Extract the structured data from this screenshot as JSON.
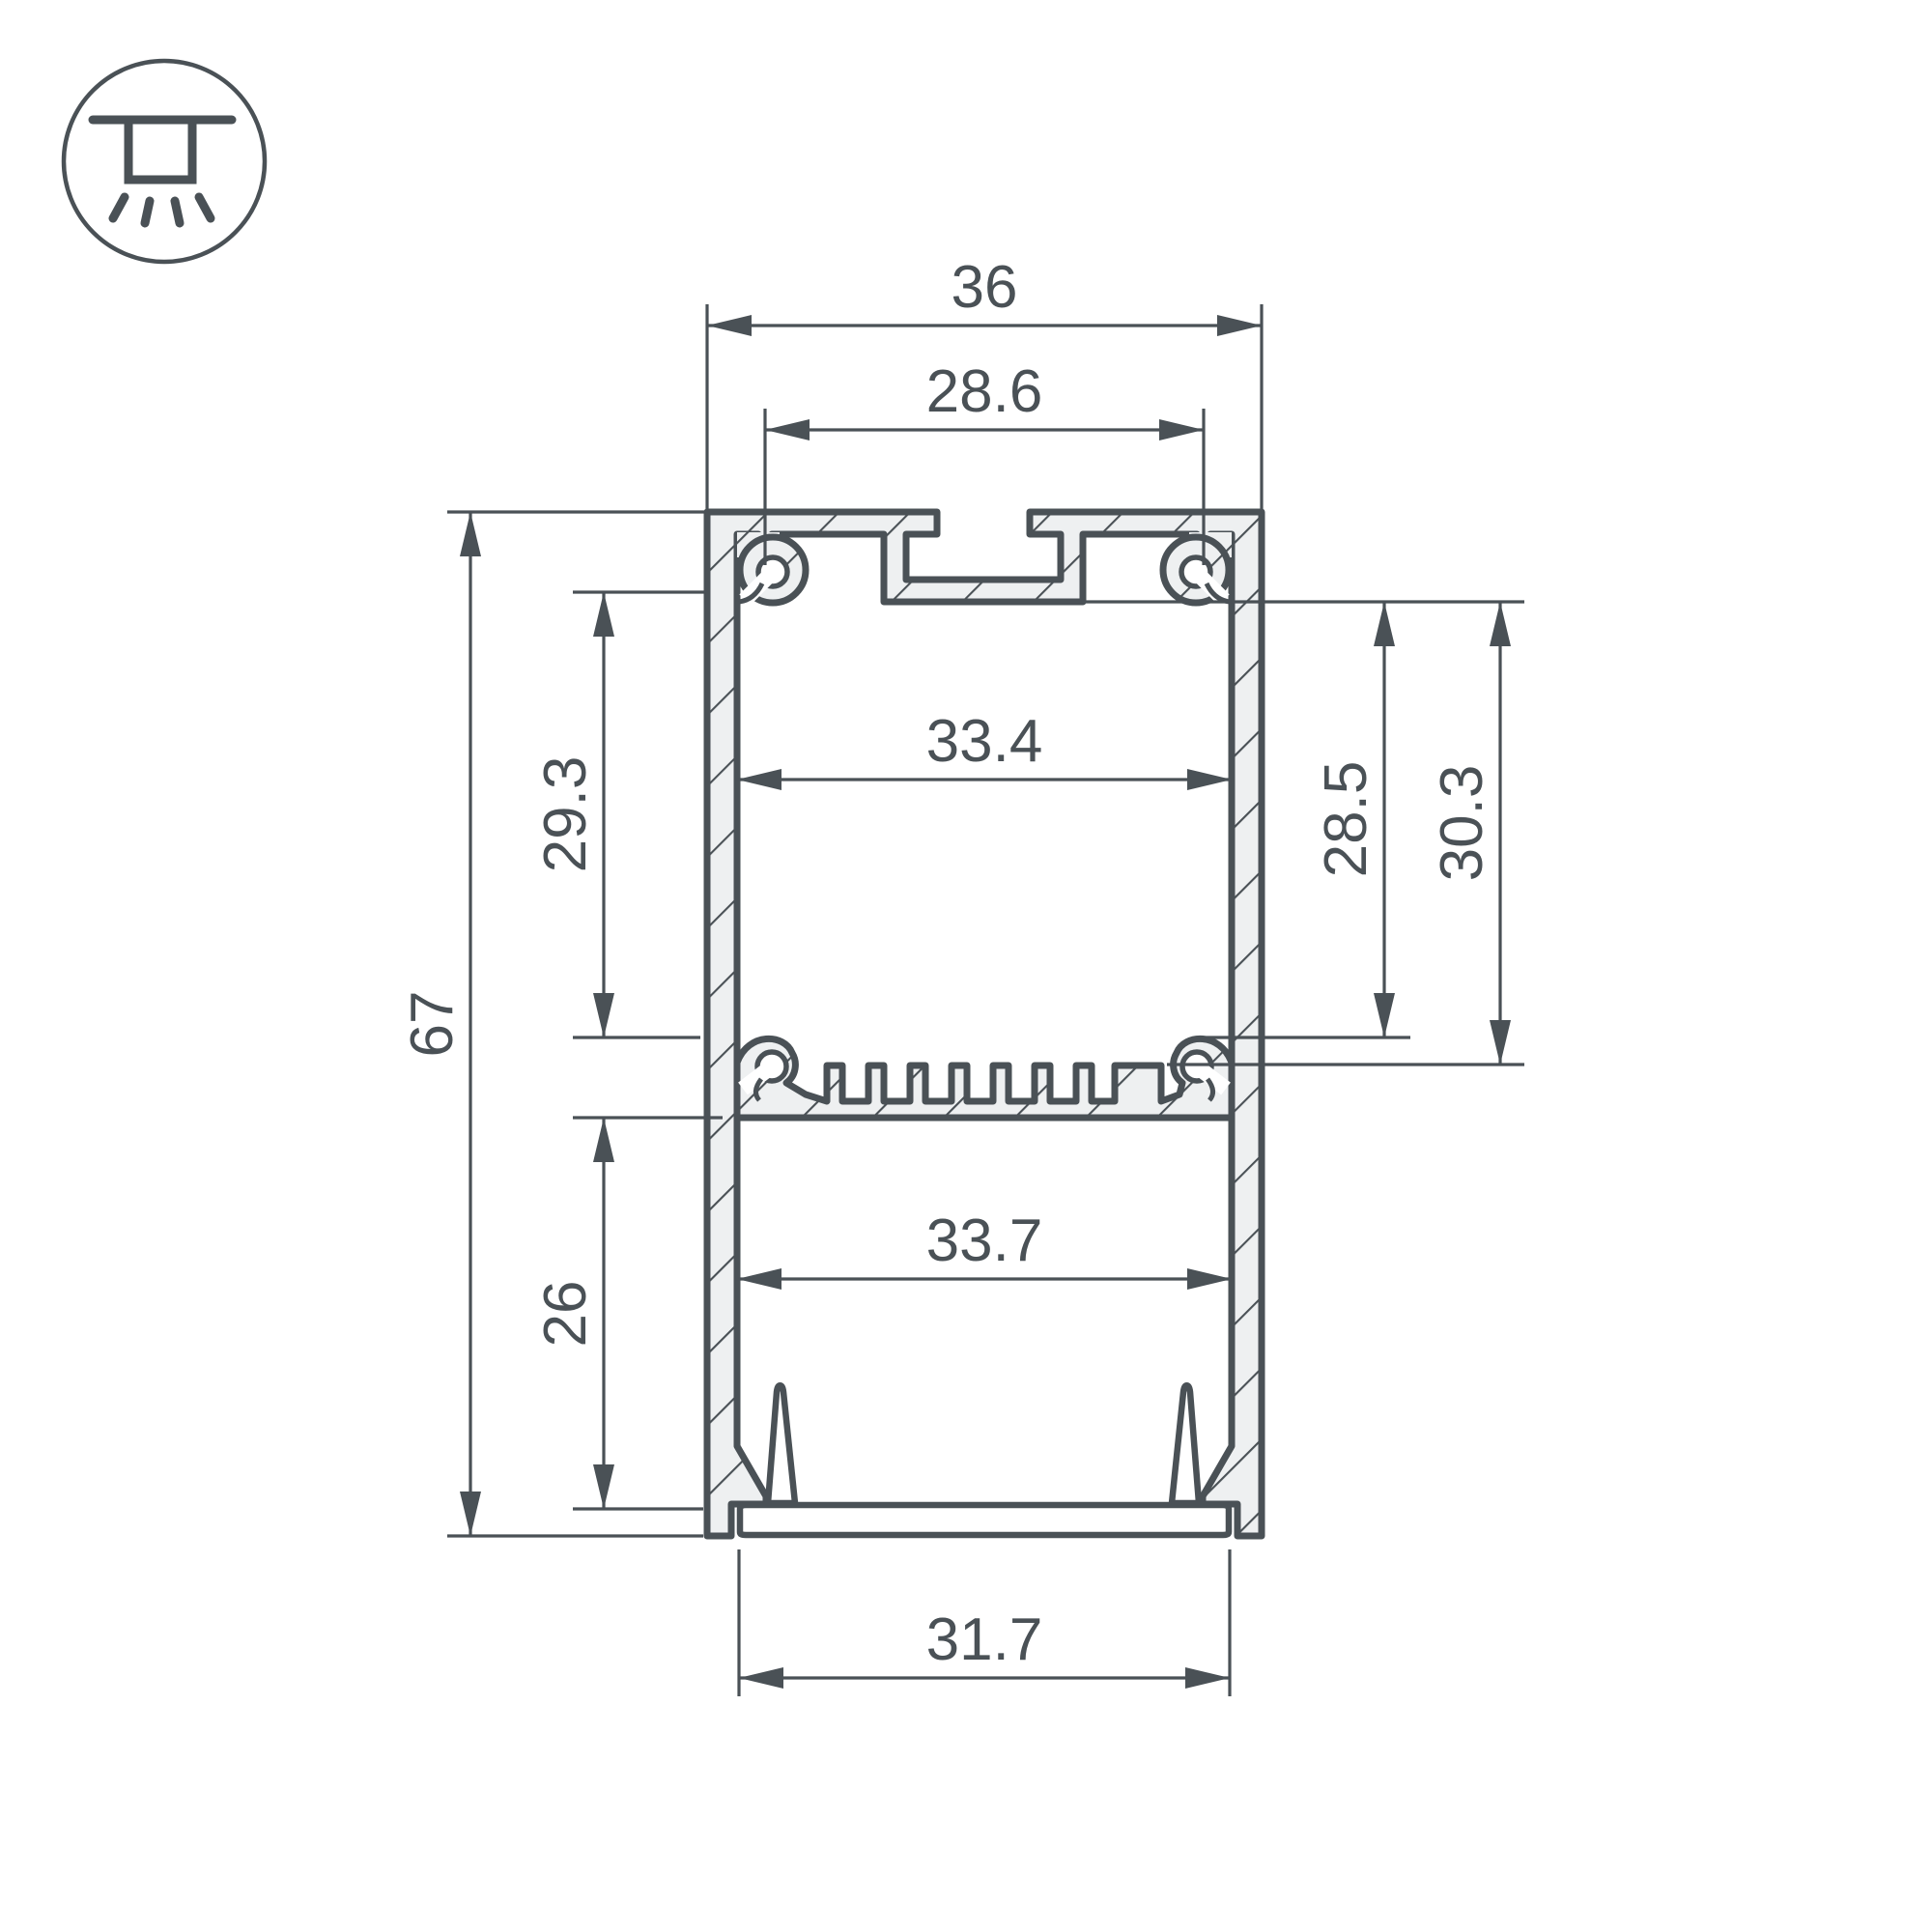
{
  "title": "LED profile cross-section drawing",
  "icon": {
    "name": "surface-ceiling-mount-icon"
  },
  "colors": {
    "line": "#4a5156",
    "aluminum_fill": "#eef0f1",
    "background": "#ffffff"
  },
  "dims": {
    "outer_width": "36",
    "top_slot_width": "28.6",
    "upper_inner_width": "33.4",
    "upper_chamber_height": "29.3",
    "overall_height": "67",
    "lower_chamber_height": "26",
    "right_height_to_boss": "28.5",
    "right_height_to_fins": "30.3",
    "lower_inner_width": "33.7",
    "bottom_opening_width": "31.7"
  }
}
